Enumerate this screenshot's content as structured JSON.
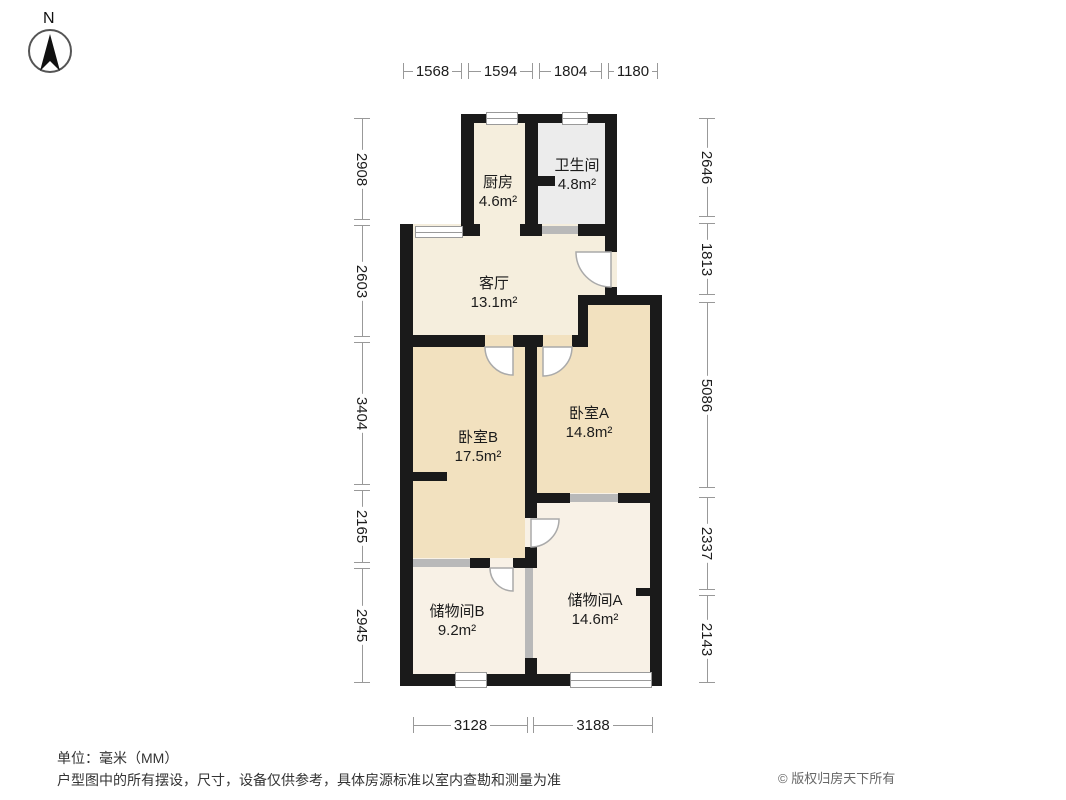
{
  "compass": {
    "north_label": "N"
  },
  "rooms": [
    {
      "name": "厨房",
      "area": "4.6m²"
    },
    {
      "name": "卫生间",
      "area": "4.8m²"
    },
    {
      "name": "客厅",
      "area": "13.1m²"
    },
    {
      "name": "卧室A",
      "area": "14.8m²"
    },
    {
      "name": "卧室B",
      "area": "17.5m²"
    },
    {
      "name": "储物间B",
      "area": "9.2m²"
    },
    {
      "name": "储物间A",
      "area": "14.6m²"
    }
  ],
  "dimensions": {
    "unit": "mm",
    "top": [
      "1568",
      "1594",
      "1804",
      "1180"
    ],
    "left": [
      "2908",
      "2603",
      "3404",
      "2165",
      "2945"
    ],
    "right": [
      "2646",
      "1813",
      "5086",
      "2337",
      "2143"
    ],
    "bottom": [
      "3128",
      "3188"
    ]
  },
  "footer": {
    "unit_note": "单位：毫米（MM）",
    "disclaimer": "户型图中的所有摆设，尺寸，设备仅供参考，具体房源标准以室内查勘和测量为准",
    "copyright": "© 版权归房天下所有"
  },
  "colors": {
    "wall": "#1a1a1a",
    "bedroom_floor": "#f2e1bf",
    "living_floor": "#f5eedd",
    "storage_floor": "#f8f1e6",
    "bath_floor": "#ececec",
    "partition": "#b9b9b9",
    "dimension_line": "#999999"
  }
}
